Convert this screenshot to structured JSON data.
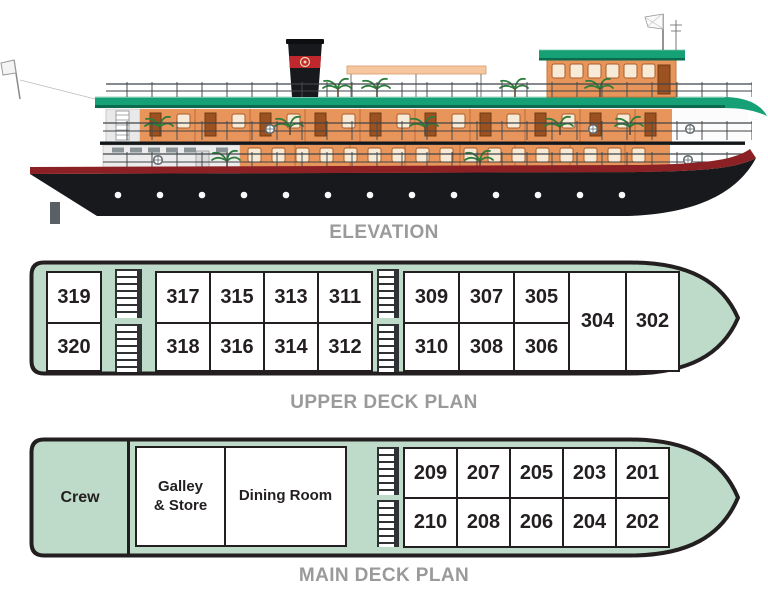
{
  "titles": {
    "elevation": "ELEVATION",
    "upper_deck": "UPPER DECK PLAN",
    "main_deck": "MAIN DECK PLAN"
  },
  "upper_deck": {
    "aft_cabins": {
      "top": "319",
      "bottom": "320"
    },
    "mid_block": {
      "top": [
        "317",
        "315",
        "313",
        "311"
      ],
      "bottom": [
        "318",
        "316",
        "314",
        "312"
      ]
    },
    "fwd_block": {
      "top": [
        "309",
        "307",
        "305"
      ],
      "bottom": [
        "310",
        "308",
        "306"
      ]
    },
    "full_height_cabins": [
      "304",
      "302"
    ]
  },
  "main_deck": {
    "crew": "Crew",
    "galley": "Galley\n& Store",
    "dining": "Dining Room",
    "fwd_block": {
      "top": [
        "209",
        "207",
        "205",
        "203",
        "201"
      ],
      "bottom": [
        "210",
        "208",
        "206",
        "204",
        "202"
      ]
    }
  },
  "icons": {
    "stairs": "hatched-ladder",
    "lifebuoy": "ring-with-cross",
    "palm": "small-palm-plant"
  },
  "colors": {
    "deck_fill": "#bedac8",
    "outline": "#231f20",
    "label_gray": "#9a9a9a",
    "roof_green": "#16a076",
    "roof_green_shadow": "#0b6b4e",
    "cabin_wall_orange": "#e8955c",
    "awning_peach": "#f6c79e",
    "hull_black": "#17191c",
    "hull_stripe_red": "#8b2125",
    "smokestack_band_red": "#c0282e"
  }
}
